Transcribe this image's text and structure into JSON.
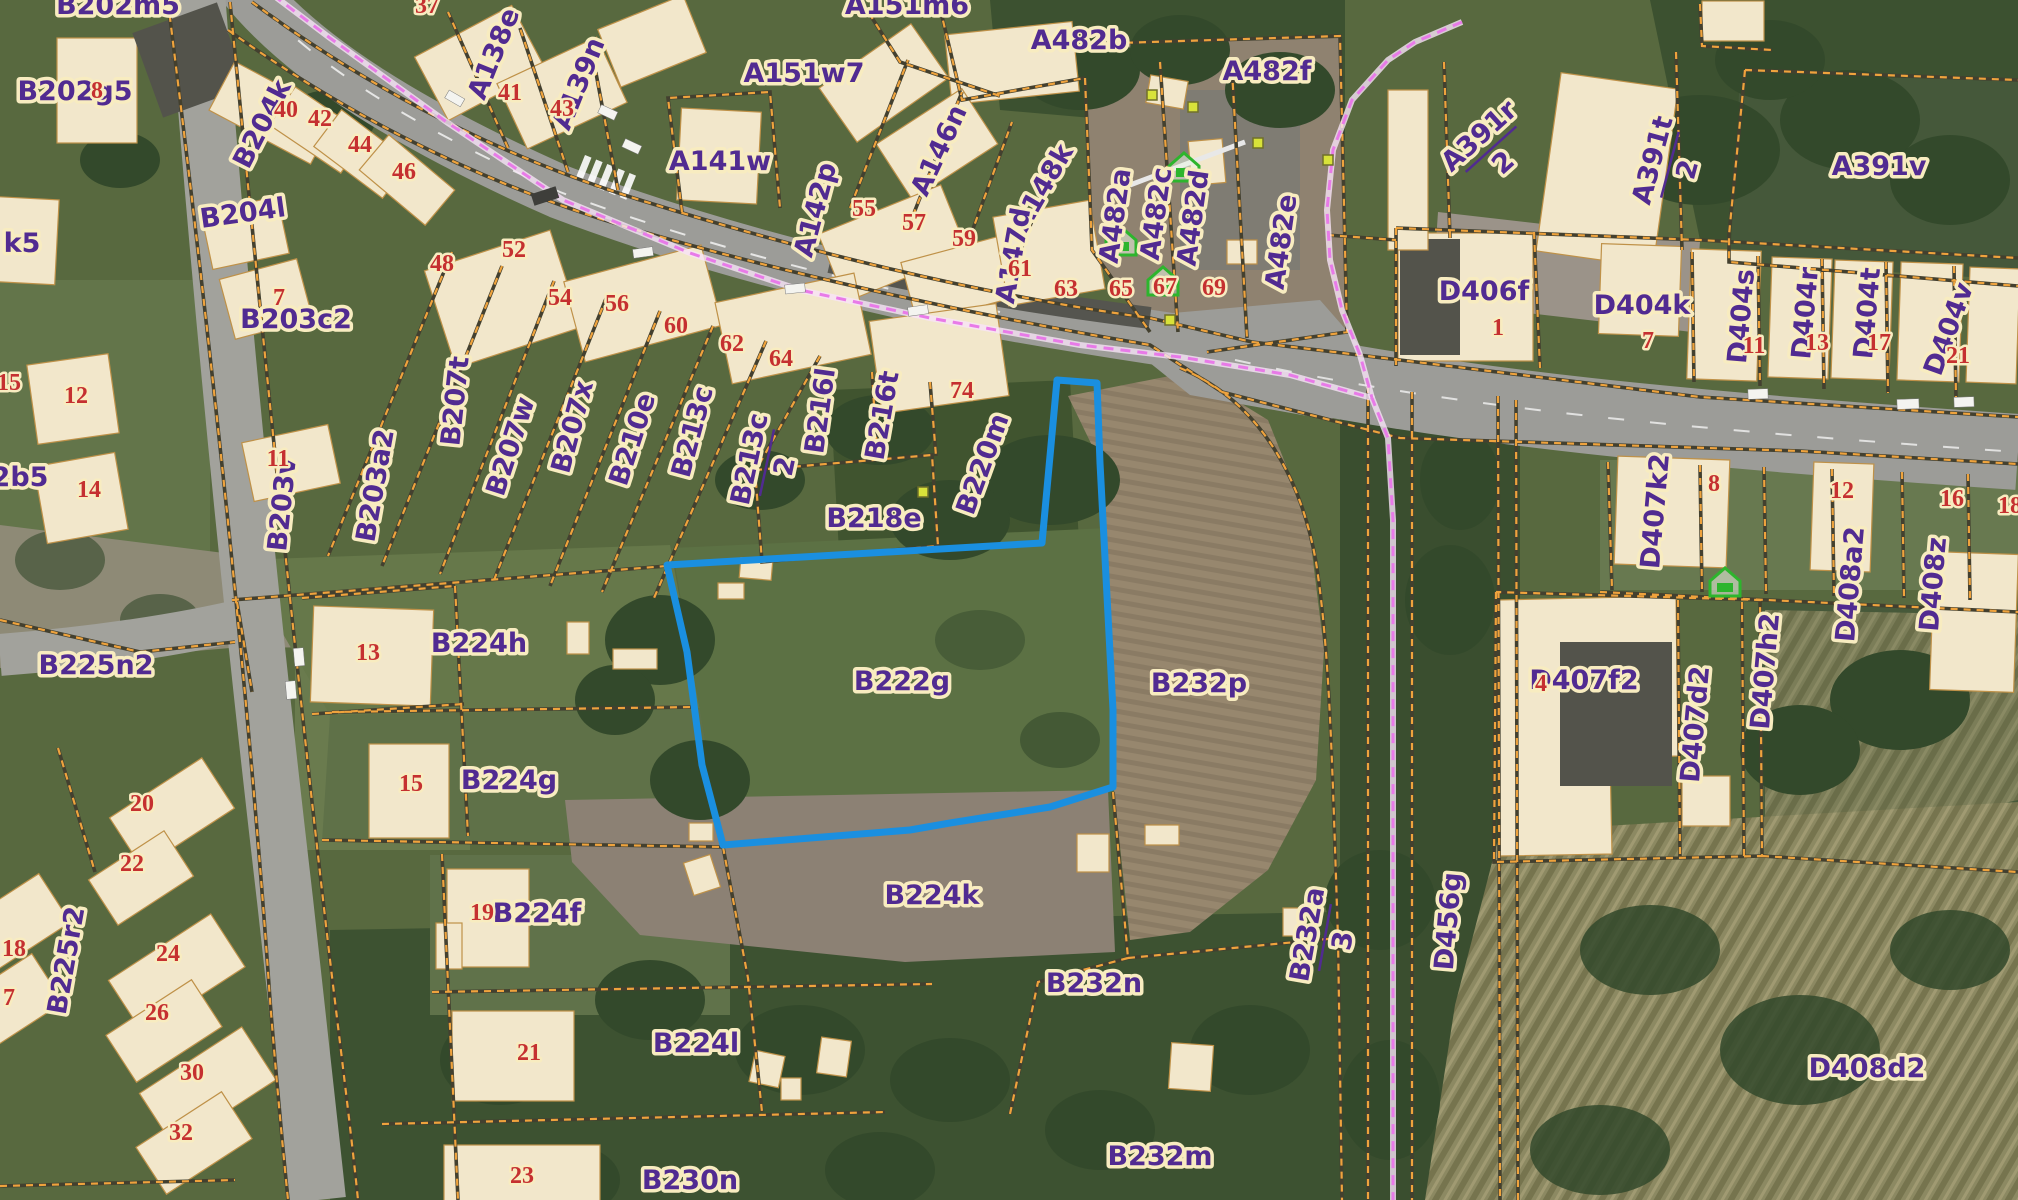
{
  "map": {
    "type": "cadastral-aerial-map",
    "highlight": {
      "parcel": "B222g",
      "outline_color": "#1a8fe0"
    },
    "colors": {
      "parcel_label": "#512b91",
      "label_halo": "#f8ecc0",
      "house_number": "#c53030",
      "parcel_line": "#efa33d",
      "boundary_line": "#e87ae8",
      "highlight_blue": "#1a8fe0",
      "building_fill": "#f2e7cb",
      "road_fill": "#9c9c98",
      "icon_green": "#2db52d",
      "corner_dot": "#d8e23a"
    },
    "parcel_labels": [
      {
        "t": "B202m5",
        "x": 118,
        "y": 14
      },
      {
        "t": "B202g5",
        "x": 75,
        "y": 100
      },
      {
        "t": "k5",
        "x": 22,
        "y": 252
      },
      {
        "t": "B204k",
        "x": 270,
        "y": 128,
        "r": -63
      },
      {
        "t": "B204l",
        "x": 244,
        "y": 222,
        "r": -8
      },
      {
        "t": "B203c2",
        "x": 296,
        "y": 328
      },
      {
        "t": "B203v",
        "x": 291,
        "y": 505,
        "r": -84
      },
      {
        "t": "B203a2",
        "x": 384,
        "y": 487,
        "r": -80
      },
      {
        "t": "2b5",
        "x": 20,
        "y": 486
      },
      {
        "t": "B207t",
        "x": 464,
        "y": 402,
        "r": -84
      },
      {
        "t": "B207w",
        "x": 519,
        "y": 449,
        "r": -72
      },
      {
        "t": "B207x",
        "x": 581,
        "y": 429,
        "r": -75
      },
      {
        "t": "B210e",
        "x": 641,
        "y": 442,
        "r": -72
      },
      {
        "t": "B213c",
        "x": 701,
        "y": 434,
        "r": -75
      },
      {
        "t": "B216l",
        "x": 829,
        "y": 412,
        "r": -82
      },
      {
        "t": "B216t",
        "x": 891,
        "y": 417,
        "r": -80
      },
      {
        "t": "B220m",
        "x": 991,
        "y": 467,
        "r": -70
      },
      {
        "t": "B218e",
        "x": 874,
        "y": 527
      },
      {
        "t": "B222g",
        "x": 902,
        "y": 690
      },
      {
        "t": "B232p",
        "x": 1199,
        "y": 692
      },
      {
        "t": "B224h",
        "x": 479,
        "y": 652
      },
      {
        "t": "B224g",
        "x": 509,
        "y": 789
      },
      {
        "t": "B225n2",
        "x": 96,
        "y": 674
      },
      {
        "t": "B225r2",
        "x": 75,
        "y": 962,
        "r": -80
      },
      {
        "t": "B224f",
        "x": 537,
        "y": 922
      },
      {
        "t": "B224l",
        "x": 696,
        "y": 1052
      },
      {
        "t": "B224k",
        "x": 932,
        "y": 904
      },
      {
        "t": "B232n",
        "x": 1094,
        "y": 992
      },
      {
        "t": "B232m",
        "x": 1160,
        "y": 1165
      },
      {
        "t": "B230n",
        "x": 690,
        "y": 1189
      },
      {
        "t": "D456g",
        "x": 1457,
        "y": 922,
        "r": -85
      },
      {
        "t": "D406f",
        "x": 1484,
        "y": 300
      },
      {
        "t": "D404k",
        "x": 1642,
        "y": 314
      },
      {
        "t": "D404s",
        "x": 1750,
        "y": 317,
        "r": -85
      },
      {
        "t": "D404r",
        "x": 1814,
        "y": 314,
        "r": -85
      },
      {
        "t": "D404t",
        "x": 1876,
        "y": 314,
        "r": -85
      },
      {
        "t": "D404v",
        "x": 1957,
        "y": 332,
        "r": -70
      },
      {
        "t": "A391v",
        "x": 1879,
        "y": 175
      },
      {
        "t": "D407k2",
        "x": 1664,
        "y": 512,
        "r": -85
      },
      {
        "t": "D407f2",
        "x": 1584,
        "y": 689
      },
      {
        "t": "D407d2",
        "x": 1704,
        "y": 725,
        "r": -85
      },
      {
        "t": "D407h2",
        "x": 1774,
        "y": 672,
        "r": -85
      },
      {
        "t": "D408a2",
        "x": 1859,
        "y": 585,
        "r": -85
      },
      {
        "t": "D408z",
        "x": 1942,
        "y": 585,
        "r": -85
      },
      {
        "t": "D408d2",
        "x": 1867,
        "y": 1077
      },
      {
        "t": "A482b",
        "x": 1079,
        "y": 49
      },
      {
        "t": "A482f",
        "x": 1267,
        "y": 80
      },
      {
        "t": "A151m6",
        "x": 907,
        "y": 14
      },
      {
        "t": "A151w7",
        "x": 804,
        "y": 82
      },
      {
        "t": "A138e",
        "x": 502,
        "y": 57,
        "r": -68
      },
      {
        "t": "A139n",
        "x": 587,
        "y": 87,
        "r": -68
      },
      {
        "t": "A141w",
        "x": 720,
        "y": 170
      },
      {
        "t": "A142p",
        "x": 824,
        "y": 212,
        "r": -75
      },
      {
        "t": "A146n",
        "x": 947,
        "y": 154,
        "r": -65
      },
      {
        "t": "A148k",
        "x": 1050,
        "y": 192,
        "r": -60
      },
      {
        "t": "A147d",
        "x": 1022,
        "y": 257,
        "r": -80
      },
      {
        "t": "A482a",
        "x": 1124,
        "y": 217,
        "r": -82
      },
      {
        "t": "A482c",
        "x": 1165,
        "y": 215,
        "r": -82
      },
      {
        "t": "A482d",
        "x": 1202,
        "y": 219,
        "r": -82
      },
      {
        "t": "A482e",
        "x": 1290,
        "y": 243,
        "r": -82
      }
    ],
    "fraction_labels": [
      {
        "top": "B213c",
        "bottom": "2",
        "x": 764,
        "y": 462,
        "r": -78
      },
      {
        "top": "B232a",
        "bottom": "3",
        "x": 1322,
        "y": 937,
        "r": -80
      },
      {
        "top": "A391r",
        "bottom": "2",
        "x": 1489,
        "y": 147,
        "r": -42
      },
      {
        "top": "A391t",
        "bottom": "2",
        "x": 1667,
        "y": 164,
        "r": -75
      }
    ],
    "house_numbers": [
      {
        "t": "8",
        "x": 97,
        "y": 98
      },
      {
        "t": "40",
        "x": 286,
        "y": 117
      },
      {
        "t": "42",
        "x": 320,
        "y": 126
      },
      {
        "t": "44",
        "x": 360,
        "y": 152
      },
      {
        "t": "46",
        "x": 404,
        "y": 179
      },
      {
        "t": "37",
        "x": 427,
        "y": 13
      },
      {
        "t": "41",
        "x": 510,
        "y": 100
      },
      {
        "t": "43",
        "x": 562,
        "y": 116
      },
      {
        "t": "48",
        "x": 442,
        "y": 271
      },
      {
        "t": "52",
        "x": 514,
        "y": 257
      },
      {
        "t": "54",
        "x": 560,
        "y": 305
      },
      {
        "t": "56",
        "x": 617,
        "y": 311
      },
      {
        "t": "60",
        "x": 676,
        "y": 333
      },
      {
        "t": "62",
        "x": 732,
        "y": 351
      },
      {
        "t": "64",
        "x": 781,
        "y": 366
      },
      {
        "t": "74",
        "x": 962,
        "y": 398
      },
      {
        "t": "55",
        "x": 864,
        "y": 216
      },
      {
        "t": "57",
        "x": 914,
        "y": 230
      },
      {
        "t": "59",
        "x": 964,
        "y": 246
      },
      {
        "t": "61",
        "x": 1020,
        "y": 276
      },
      {
        "t": "63",
        "x": 1066,
        "y": 296
      },
      {
        "t": "65",
        "x": 1121,
        "y": 296
      },
      {
        "t": "67",
        "x": 1165,
        "y": 294
      },
      {
        "t": "69",
        "x": 1214,
        "y": 295
      },
      {
        "t": "7",
        "x": 279,
        "y": 305
      },
      {
        "t": "12",
        "x": 76,
        "y": 403
      },
      {
        "t": "11",
        "x": 278,
        "y": 466
      },
      {
        "t": "14",
        "x": 89,
        "y": 497
      },
      {
        "t": "15",
        "x": 9,
        "y": 390
      },
      {
        "t": "13",
        "x": 368,
        "y": 660
      },
      {
        "t": "15",
        "x": 411,
        "y": 791
      },
      {
        "t": "20",
        "x": 142,
        "y": 811
      },
      {
        "t": "22",
        "x": 132,
        "y": 871
      },
      {
        "t": "24",
        "x": 168,
        "y": 961
      },
      {
        "t": "26",
        "x": 157,
        "y": 1020
      },
      {
        "t": "30",
        "x": 192,
        "y": 1080
      },
      {
        "t": "32",
        "x": 181,
        "y": 1140
      },
      {
        "t": "18",
        "x": 14,
        "y": 956
      },
      {
        "t": "7",
        "x": 9,
        "y": 1005
      },
      {
        "t": "19",
        "x": 482,
        "y": 920
      },
      {
        "t": "21",
        "x": 529,
        "y": 1060
      },
      {
        "t": "23",
        "x": 522,
        "y": 1183
      },
      {
        "t": "1",
        "x": 1498,
        "y": 335
      },
      {
        "t": "7",
        "x": 1648,
        "y": 348
      },
      {
        "t": "11",
        "x": 1754,
        "y": 353
      },
      {
        "t": "13",
        "x": 1817,
        "y": 350
      },
      {
        "t": "17",
        "x": 1879,
        "y": 350
      },
      {
        "t": "21",
        "x": 1958,
        "y": 363
      },
      {
        "t": "8",
        "x": 1714,
        "y": 491
      },
      {
        "t": "12",
        "x": 1842,
        "y": 498
      },
      {
        "t": "16",
        "x": 1952,
        "y": 506
      },
      {
        "t": "18",
        "x": 2010,
        "y": 513
      },
      {
        "t": "4",
        "x": 1541,
        "y": 691
      }
    ],
    "green_house_icons": [
      {
        "x": 1184,
        "y": 168
      },
      {
        "x": 1121,
        "y": 242
      },
      {
        "x": 1163,
        "y": 282
      },
      {
        "x": 1725,
        "y": 583
      }
    ],
    "corner_dots": [
      {
        "x": 1152,
        "y": 95
      },
      {
        "x": 1193,
        "y": 107
      },
      {
        "x": 1258,
        "y": 143
      },
      {
        "x": 1170,
        "y": 320
      },
      {
        "x": 923,
        "y": 492
      },
      {
        "x": 1328,
        "y": 160
      }
    ]
  }
}
